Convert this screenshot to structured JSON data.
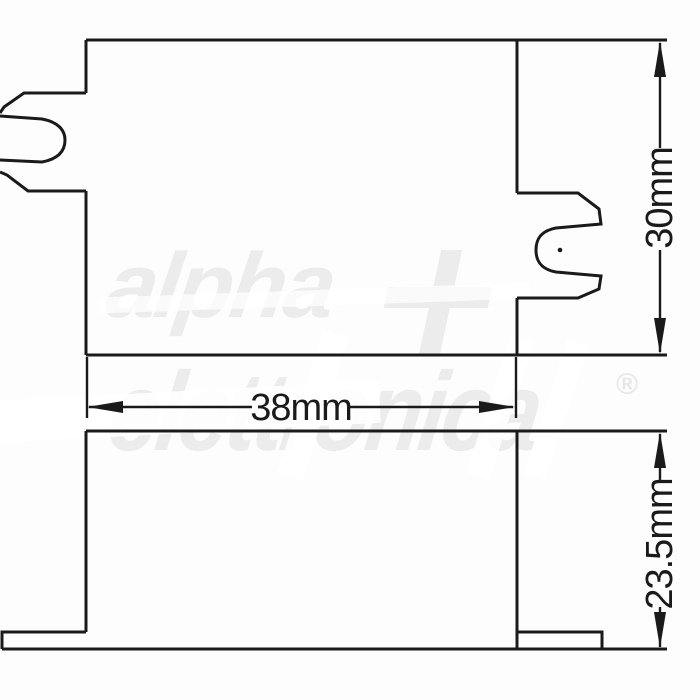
{
  "diagram": {
    "kind": "technical-drawing",
    "views": [
      {
        "name": "top-view",
        "features": [
          "left mounting clip with rounded cavity",
          "right mounting clip with rounded cavity and pilot dot"
        ]
      },
      {
        "name": "front-view",
        "features": [
          "left base flange",
          "right base flange"
        ]
      }
    ]
  },
  "dimensions": {
    "width": {
      "label": "38mm",
      "value_mm": 38
    },
    "height": {
      "label": "30mm",
      "value_mm": 30
    },
    "depth": {
      "label": "23.5mm",
      "value_mm": 23.5
    }
  },
  "watermark": {
    "line1": "alpha",
    "line2": "elettronica",
    "registered": "®",
    "plus_icon": "plus-cross"
  },
  "colors": {
    "line": "#1a1a1a",
    "dimension_text": "#1a1a1a",
    "watermark": "#ececec",
    "background": "#fdfdfd"
  }
}
